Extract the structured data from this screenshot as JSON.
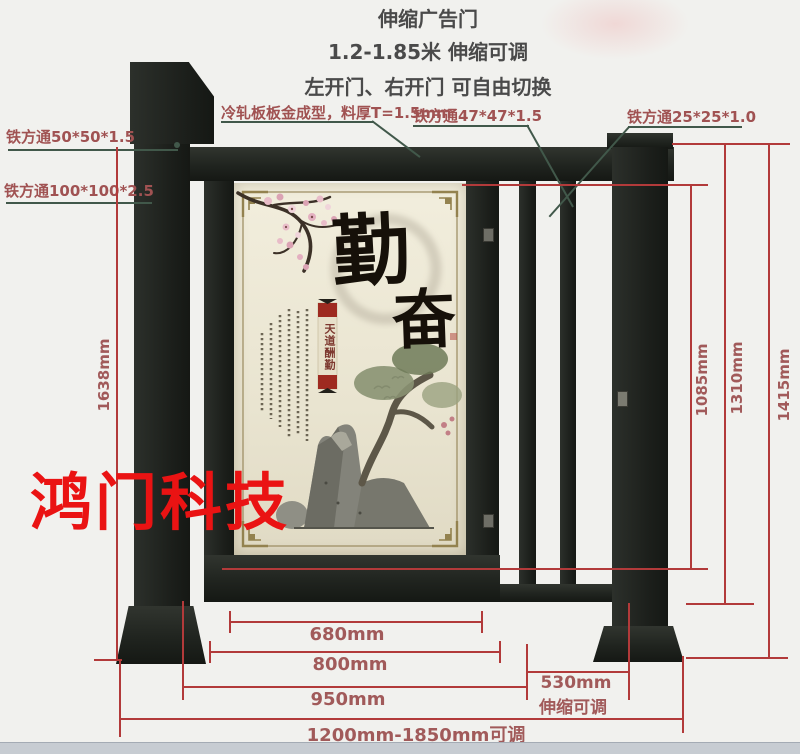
{
  "header": {
    "title": "伸缩广告门",
    "subtitle_range": "1.2-1.85米 伸缩可调",
    "subtitle_opening": "左开门、右开门 可自由切换"
  },
  "callouts": {
    "tube_50": "铁方通50*50*1.5",
    "tube_100": "铁方通100*100*2.5",
    "cold_plate": "冷轧板板金成型，料厚T=1.5mm",
    "tube_47": "铁方通47*47*1.5",
    "tube_25": "铁方通25*25*1.0"
  },
  "dimensions": {
    "total_height": "1638mm",
    "rail_height": "1085mm",
    "door_height": "1310mm",
    "post_height": "1415mm",
    "panel_width": "680mm",
    "door_width": "800mm",
    "opening_width": "950mm",
    "telescopic_width": "530mm",
    "telescopic_note": "伸缩可调",
    "total_width": "1200mm-1850mm可调"
  },
  "poster": {
    "calligraphy_char_1": "勤",
    "calligraphy_char_2": "奋",
    "seal_text": "天道酬勤"
  },
  "watermark": "鸿门科技",
  "colors": {
    "dimension_line": "#b23a3a",
    "dimension_text": "#a15a5a",
    "callout_text": "#a05252",
    "leader_line": "#41584a",
    "watermark_red": "#ea1313",
    "gate_metal": "#20241f",
    "poster_cream": "#ece8d6",
    "seal_red": "#9e2a20"
  }
}
